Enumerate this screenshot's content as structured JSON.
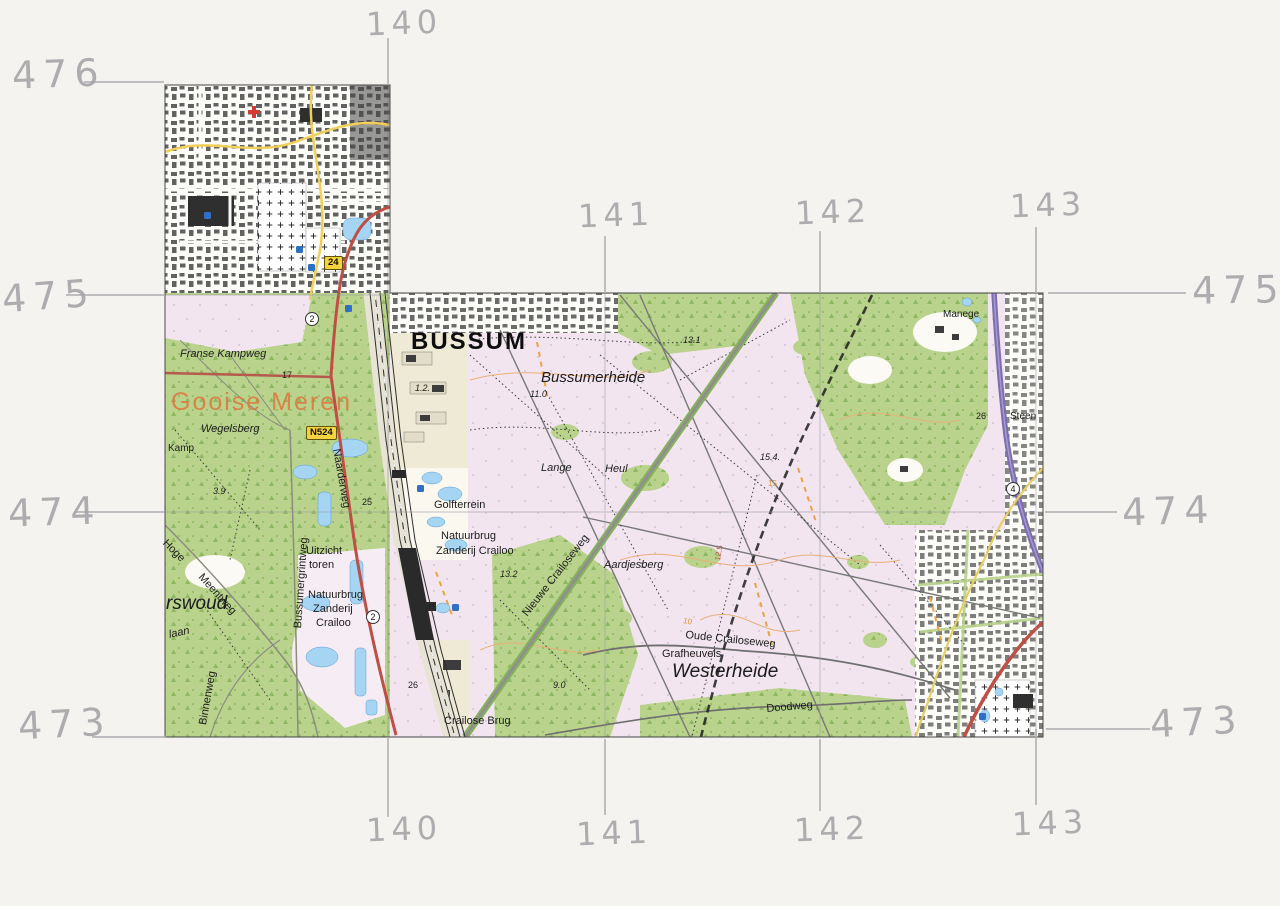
{
  "page": {
    "kind": "scanned topographic map sheet with hand-drawn kilometre grid"
  },
  "colors": {
    "paper": "#f5f3ef",
    "pencil": "#a3a0a6",
    "forest_green": "#b9d38c",
    "heath_pink": "#f2e5ef",
    "water_blue": "#a5d5f3",
    "motorway_purple": "#7b6db0",
    "road_red": "#bf4f45",
    "road_yellow": "#f1cf58",
    "municipality_orange": "#dc763e"
  },
  "grid": {
    "left": [
      "476",
      "475",
      "474",
      "473"
    ],
    "right": [
      "475",
      "474",
      "473"
    ],
    "top": [
      "140",
      "141",
      "142",
      "143"
    ],
    "bottom": [
      "140",
      "141",
      "142",
      "143"
    ]
  },
  "map": {
    "labels": {
      "bussum": "BUSSUM",
      "bussumerheide": "Bussumerheide",
      "westerheide": "Westerheide",
      "gooise_meren": "Gooise Meren",
      "franse_kampweg": "Franse Kampweg",
      "wegelsberg": "Wegelsberg",
      "kamp": "Kamp",
      "rswoud": "rswoud",
      "laan": "laan",
      "binnenweg": "Binnenweg",
      "hoge": "Hoge",
      "meentweg": "Meentweg",
      "bussumergrintweg": "Bussumergrintweg",
      "uitzicht": "Uitzicht",
      "toren": "toren",
      "natuurbrug_w1": "Natuurbrug",
      "natuurbrug_w2": "Zanderij",
      "natuurbrug_w3": "Crailoo",
      "golfterrein": "Golfterrein",
      "natuurbrug_e1": "Natuurbrug",
      "natuurbrug_e2": "Zanderij Crailoo",
      "naarderweg": "Naarderweg",
      "nieuwe_crailoseweg": "Nieuwe Crailoseweg",
      "oude_crailoseweg": "Oude Crailoseweg",
      "grafheuvels": "Grafheuvels",
      "aardjesberg": "Aardjesberg",
      "doodweg": "Doodweg",
      "crailose_brug": "Crailose Brug",
      "lange": "Lange",
      "heul": "Heul",
      "manege": "Manege",
      "steen": "Steen",
      "n524": "N524",
      "route24": "24",
      "circ2a": "2",
      "circ2b": "2",
      "circ4": "4",
      "s17": "17",
      "s25": "25",
      "s26_rail": "26",
      "s26_right": "26",
      "s1_2": "1.2.",
      "s3_9": "3.9",
      "s9_0": "9.0",
      "s11_0": "11.0",
      "s13_1": "13.1",
      "s13_2": "13.2",
      "s15_4": "15.4.",
      "c12_5": "12.5",
      "c10": "10",
      "c15": "15"
    }
  }
}
